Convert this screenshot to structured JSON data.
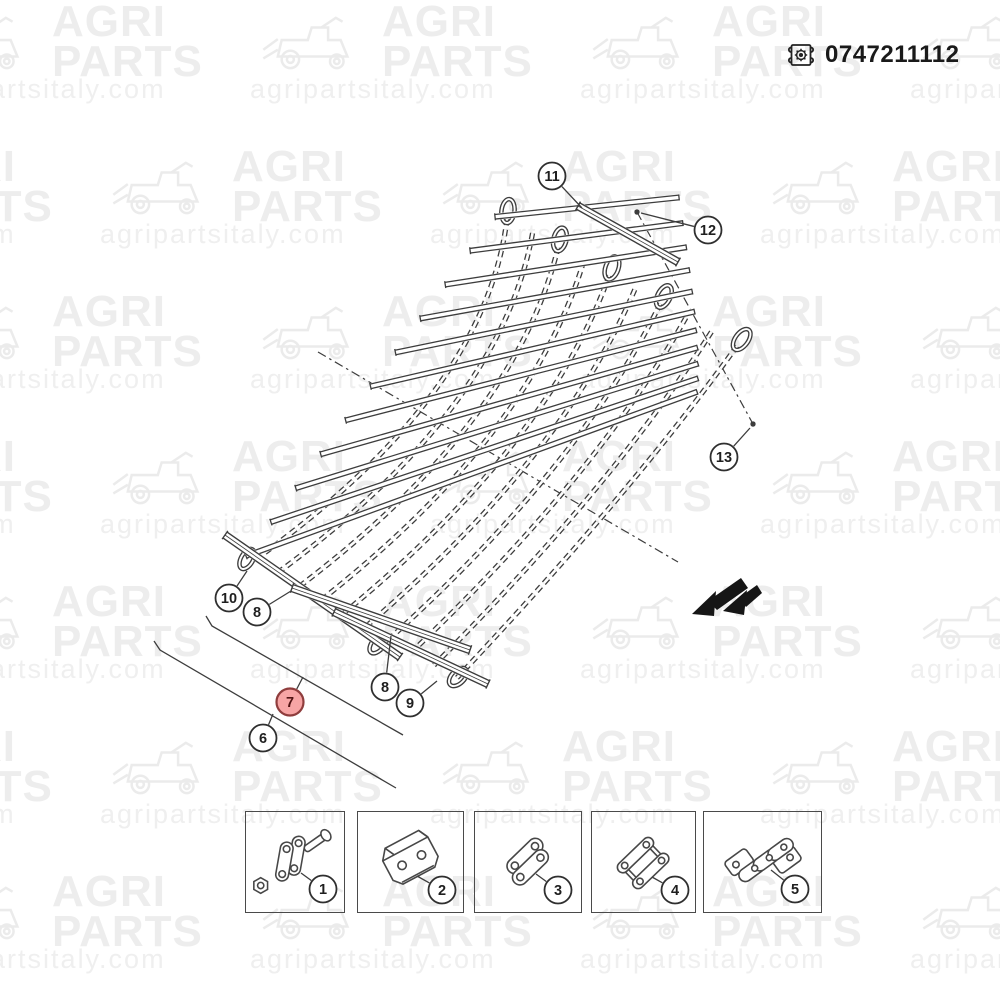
{
  "header": {
    "part_number": "0747211112",
    "icon": "blueprint-scroll-gear-icon"
  },
  "watermark": {
    "brand_line1": "AGRI",
    "brand_line2": "PARTS",
    "url": "agripartsitaly.com"
  },
  "diagram": {
    "line_color": "#3d3d3d",
    "highlight": {
      "fill": "#f7a5a5",
      "stroke": "#8f3d3d",
      "text": "#511313"
    },
    "direction_arrow": "black-double-arrow-down-left",
    "callouts": [
      {
        "id": "callout-11",
        "label": "11",
        "x": 552,
        "y": 176,
        "leader_to": [
          582,
          208
        ]
      },
      {
        "id": "callout-12",
        "label": "12",
        "x": 708,
        "y": 230,
        "leader_to": [
          641,
          213
        ],
        "dot": [
          637,
          212
        ]
      },
      {
        "id": "callout-13",
        "label": "13",
        "x": 724,
        "y": 457,
        "leader_to": [
          750,
          428
        ],
        "dot": [
          753,
          424
        ]
      },
      {
        "id": "callout-10",
        "label": "10",
        "x": 229,
        "y": 598,
        "leader_to": [
          247,
          571
        ]
      },
      {
        "id": "callout-8-left",
        "label": "8",
        "x": 257,
        "y": 612,
        "leader_to": [
          291,
          591
        ]
      },
      {
        "id": "callout-7",
        "label": "7",
        "x": 290,
        "y": 702,
        "highlighted": true,
        "leader_to": [
          303,
          677
        ]
      },
      {
        "id": "callout-6",
        "label": "6",
        "x": 263,
        "y": 738,
        "leader_to": [
          273,
          714
        ]
      },
      {
        "id": "callout-8-right",
        "label": "8",
        "x": 385,
        "y": 687,
        "leader_to": [
          391,
          636
        ]
      },
      {
        "id": "callout-9",
        "label": "9",
        "x": 410,
        "y": 703,
        "leader_to": [
          437,
          681
        ]
      },
      {
        "id": "callout-1",
        "label": "1",
        "x": 323,
        "y": 889,
        "leader_to": [
          301,
          873
        ]
      },
      {
        "id": "callout-2",
        "label": "2",
        "x": 442,
        "y": 890,
        "leader_to": [
          417,
          876
        ]
      },
      {
        "id": "callout-3",
        "label": "3",
        "x": 558,
        "y": 890,
        "leader_to": [
          536,
          874
        ]
      },
      {
        "id": "callout-4",
        "label": "4",
        "x": 675,
        "y": 890,
        "leader_to": [
          652,
          877
        ]
      },
      {
        "id": "callout-5",
        "label": "5",
        "x": 795,
        "y": 889,
        "leader_to": [
          771,
          870
        ]
      }
    ]
  },
  "legend": {
    "boxes": [
      {
        "id": "part-box-1",
        "callout": "1"
      },
      {
        "id": "part-box-2",
        "callout": "2"
      },
      {
        "id": "part-box-3",
        "callout": "3"
      },
      {
        "id": "part-box-4",
        "callout": "4"
      },
      {
        "id": "part-box-5",
        "callout": "5"
      }
    ]
  }
}
